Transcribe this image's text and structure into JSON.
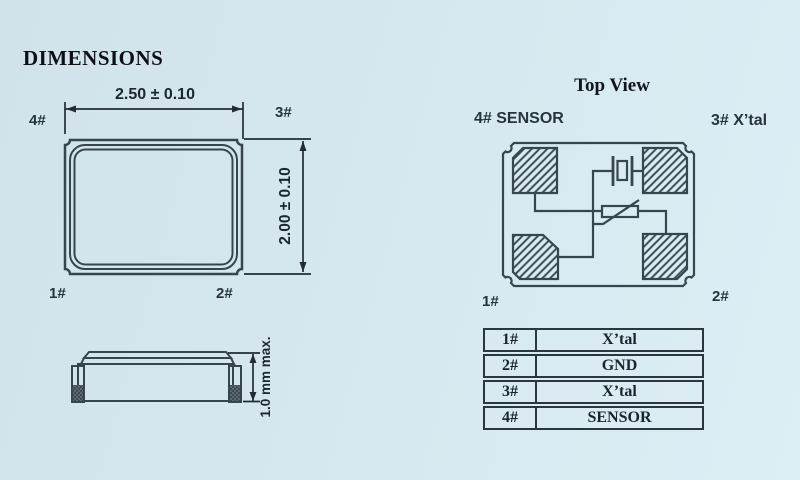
{
  "page": {
    "heading": "DIMENSIONS",
    "background": "#d6e7ef",
    "line_color": "#37454f",
    "text_color": "#1c2630"
  },
  "front_view": {
    "width_dimension": "2.50 ± 0.10",
    "height_dimension": "2.00 ± 0.10",
    "pin_top_left": "4#",
    "pin_top_right": "3#",
    "pin_bottom_left": "1#",
    "pin_bottom_right": "2#"
  },
  "side_view": {
    "height_dimension": "1.0 mm max."
  },
  "top_view": {
    "title": "Top View",
    "label_top_left": "4# SENSOR",
    "label_top_right": "3# X’tal",
    "label_bottom_left": "1#",
    "label_bottom_right": "2#"
  },
  "pin_table": {
    "rows": [
      {
        "pin": "1#",
        "function": "X’tal"
      },
      {
        "pin": "2#",
        "function": "GND"
      },
      {
        "pin": "3#",
        "function": "X’tal"
      },
      {
        "pin": "4#",
        "function": "SENSOR"
      }
    ]
  }
}
